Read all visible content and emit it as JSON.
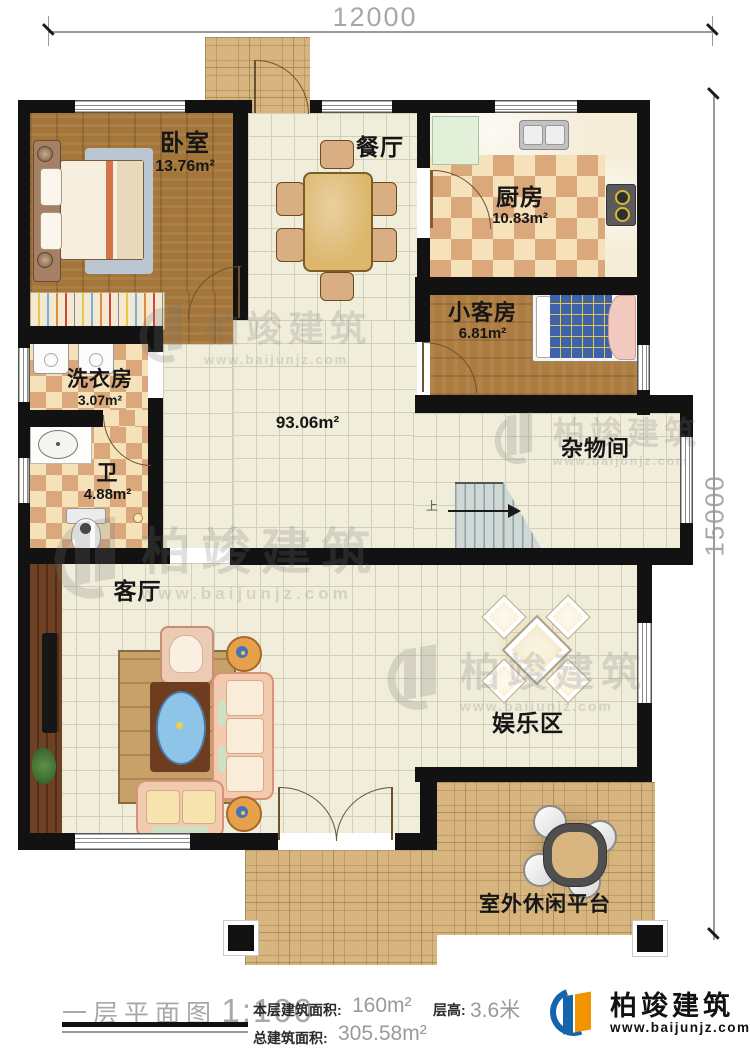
{
  "dimensions": {
    "width_top": "12000",
    "height_right": "15000"
  },
  "rooms": {
    "bedroom": {
      "name": "卧室",
      "area": "13.76m²"
    },
    "dining": {
      "name": "餐厅"
    },
    "kitchen": {
      "name": "厨房",
      "area": "10.83m²"
    },
    "guest_room": {
      "name": "小客房",
      "area": "6.81m²"
    },
    "laundry": {
      "name": "洗衣房",
      "area": "3.07m²"
    },
    "bathroom": {
      "name": "卫",
      "area": "4.88m²"
    },
    "hall": {
      "area": "93.06m²"
    },
    "storage": {
      "name": "杂物间"
    },
    "living_room": {
      "name": "客厅"
    },
    "entertainment": {
      "name": "娱乐区"
    },
    "outdoor_platform": {
      "name": "室外休闲平台"
    }
  },
  "stairs": {
    "direction_label": "上"
  },
  "footer": {
    "plan_title": "一层平面图",
    "scale": "1:100",
    "floor_area_label": "本层建筑面积:",
    "floor_area_value": "160m²",
    "story_height_label": "层高:",
    "story_height_value": "3.6米",
    "total_area_label": "总建筑面积:",
    "total_area_value": "305.58m²"
  },
  "brand": {
    "name": "柏竣建筑",
    "website": "www.baijunjz.com"
  },
  "watermark": {
    "name": "柏竣建筑",
    "website": "www.baijunjz.com"
  },
  "colors": {
    "wall": "#121212",
    "brand_blue": "#1565ad",
    "brand_orange": "#f29400"
  }
}
